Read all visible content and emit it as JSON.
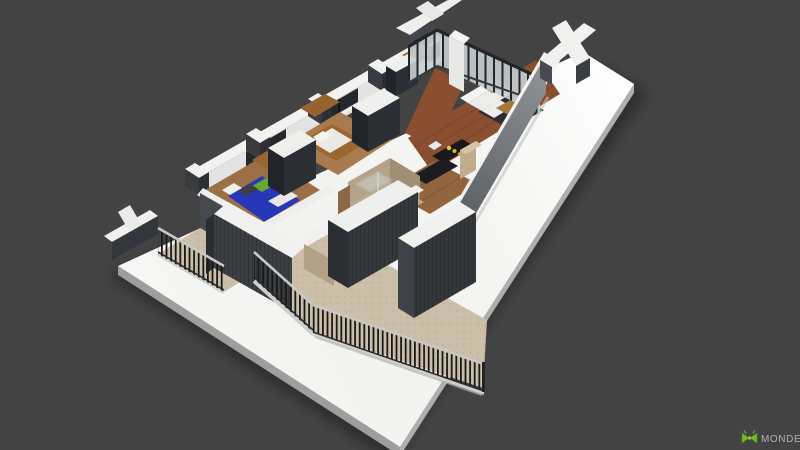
{
  "meta": {
    "type": "3D architectural floor plan model render",
    "view": "isometric aerial view of apartment maquette on white display base"
  },
  "logo": {
    "text": "MONDE",
    "icon": "green-bow-logo-icon",
    "icon_color": "#7ab52d",
    "icon_shade": "#4e8c1e",
    "text_color": "#b2b2b2"
  },
  "palette": {
    "background": "#434343",
    "platform_top": "#f6f6f4",
    "platform_side_sw": "#9e9e9c",
    "platform_side_se": "#aeaeac",
    "wall_cap": "#f2f2f0",
    "wall_face_inner": "#e3e3e1",
    "wall_dark": "#3f4246",
    "wardrobe_dark": "#24272b",
    "facade_light": "#8e9296",
    "facade_shadow": "#53565a",
    "glass_pane": "#c6ced2",
    "glass_frame": "#22252a",
    "wood_floor": "#8a4e30",
    "wood_kitchen": "#92653e",
    "wood_furniture": "#9a6536",
    "balcony_floor": "#cbbfa9",
    "railing_bar": "#1a1a1a",
    "railing_cap": "#c8c8c6",
    "bed_blue": "#2637b8",
    "pillow_green": "#64a832",
    "sofa_white": "#ececea",
    "armchair_green": "#66982f",
    "counter_black": "#17191c",
    "bathroom_wall": "#b4a389",
    "rug_dark": "#2c2e32"
  }
}
